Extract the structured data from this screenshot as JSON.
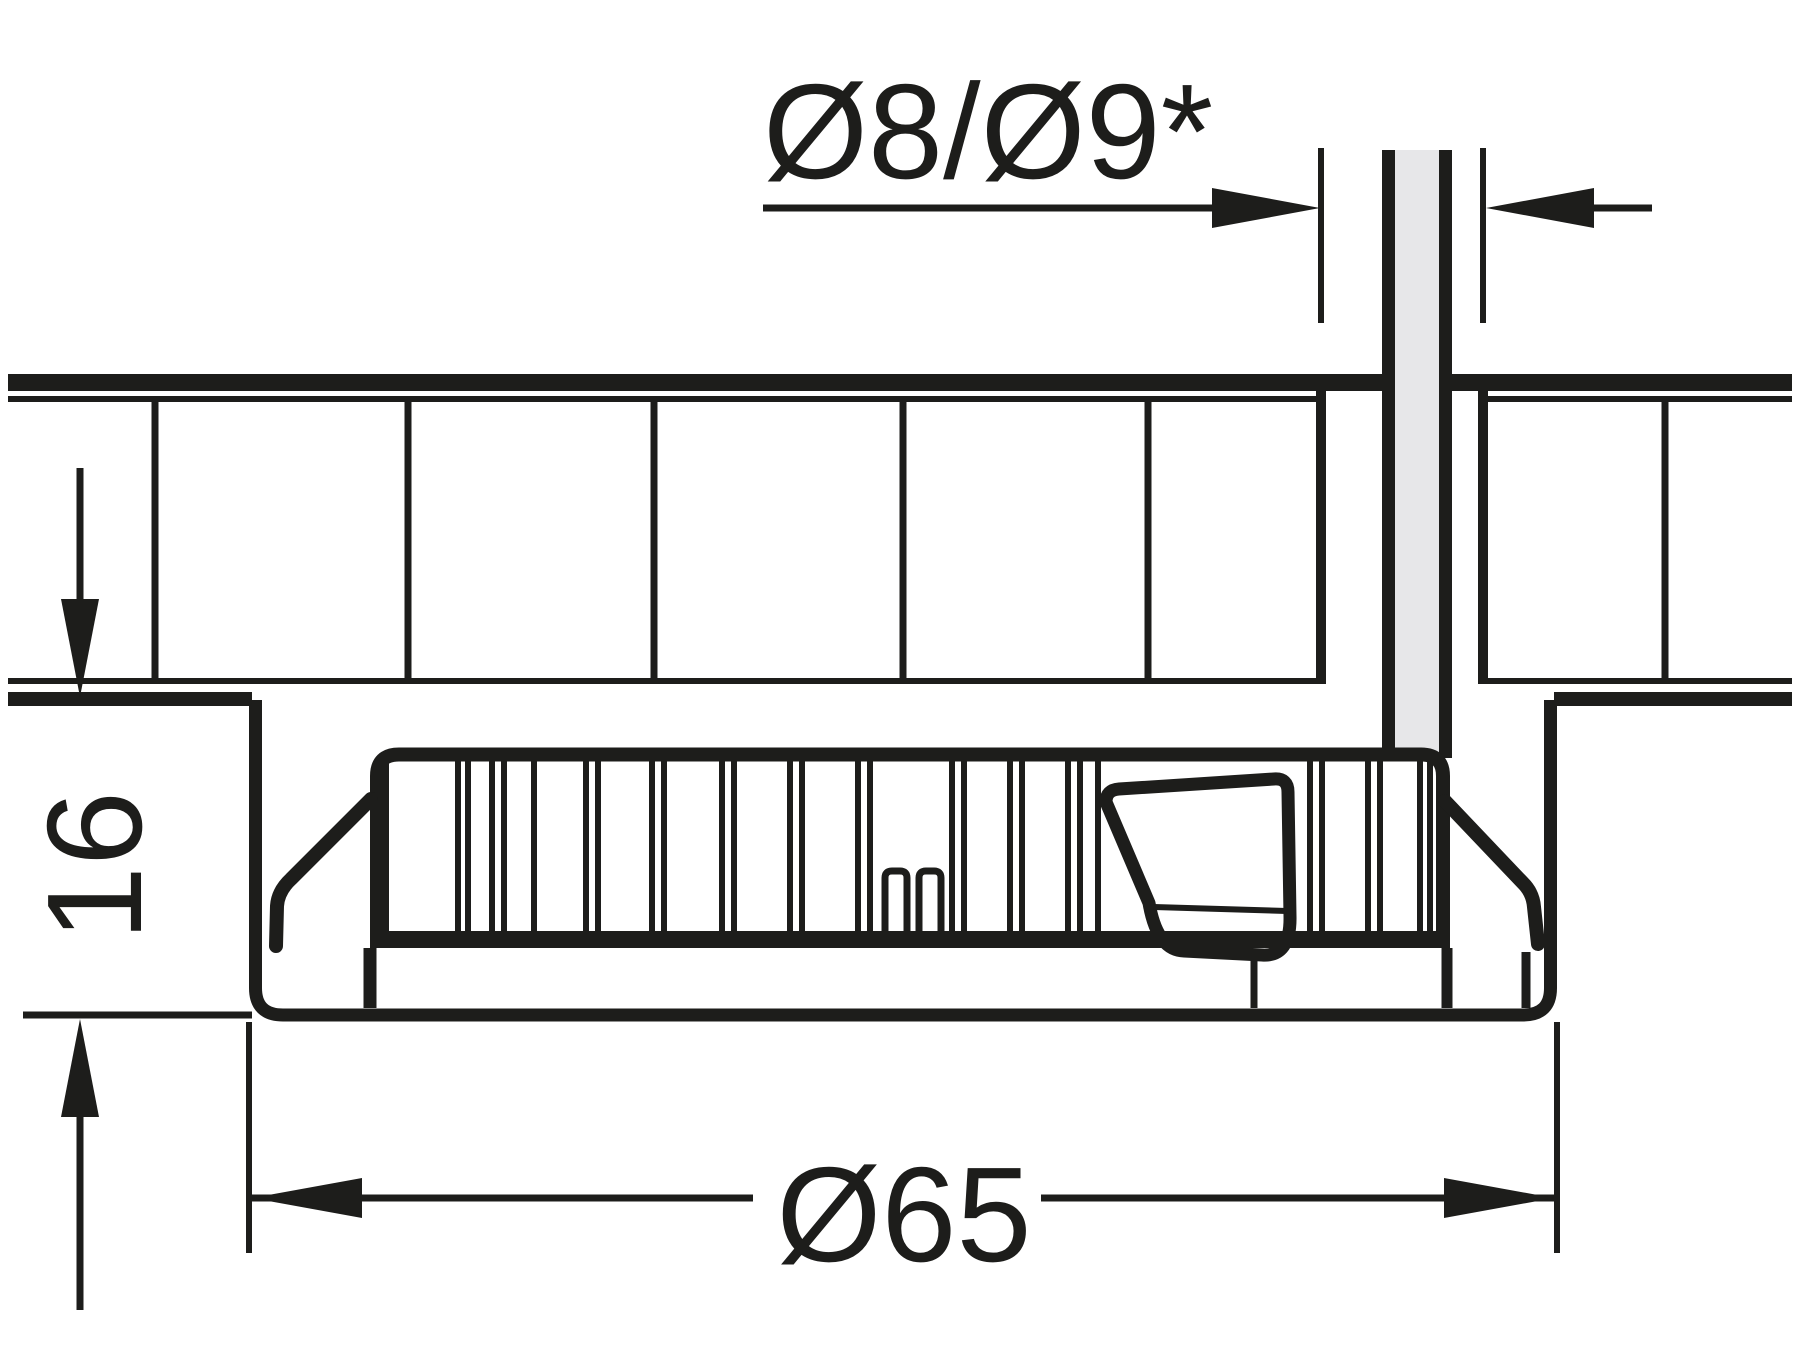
{
  "drawing": {
    "labels": {
      "cable_hole": "Ø8/Ø9*",
      "mounting_depth": "16",
      "flange_diameter": "Ø65"
    },
    "colors": {
      "ink": "#1d1d1b",
      "cable_fill": "#e7e7e9",
      "background": "#ffffff"
    }
  }
}
